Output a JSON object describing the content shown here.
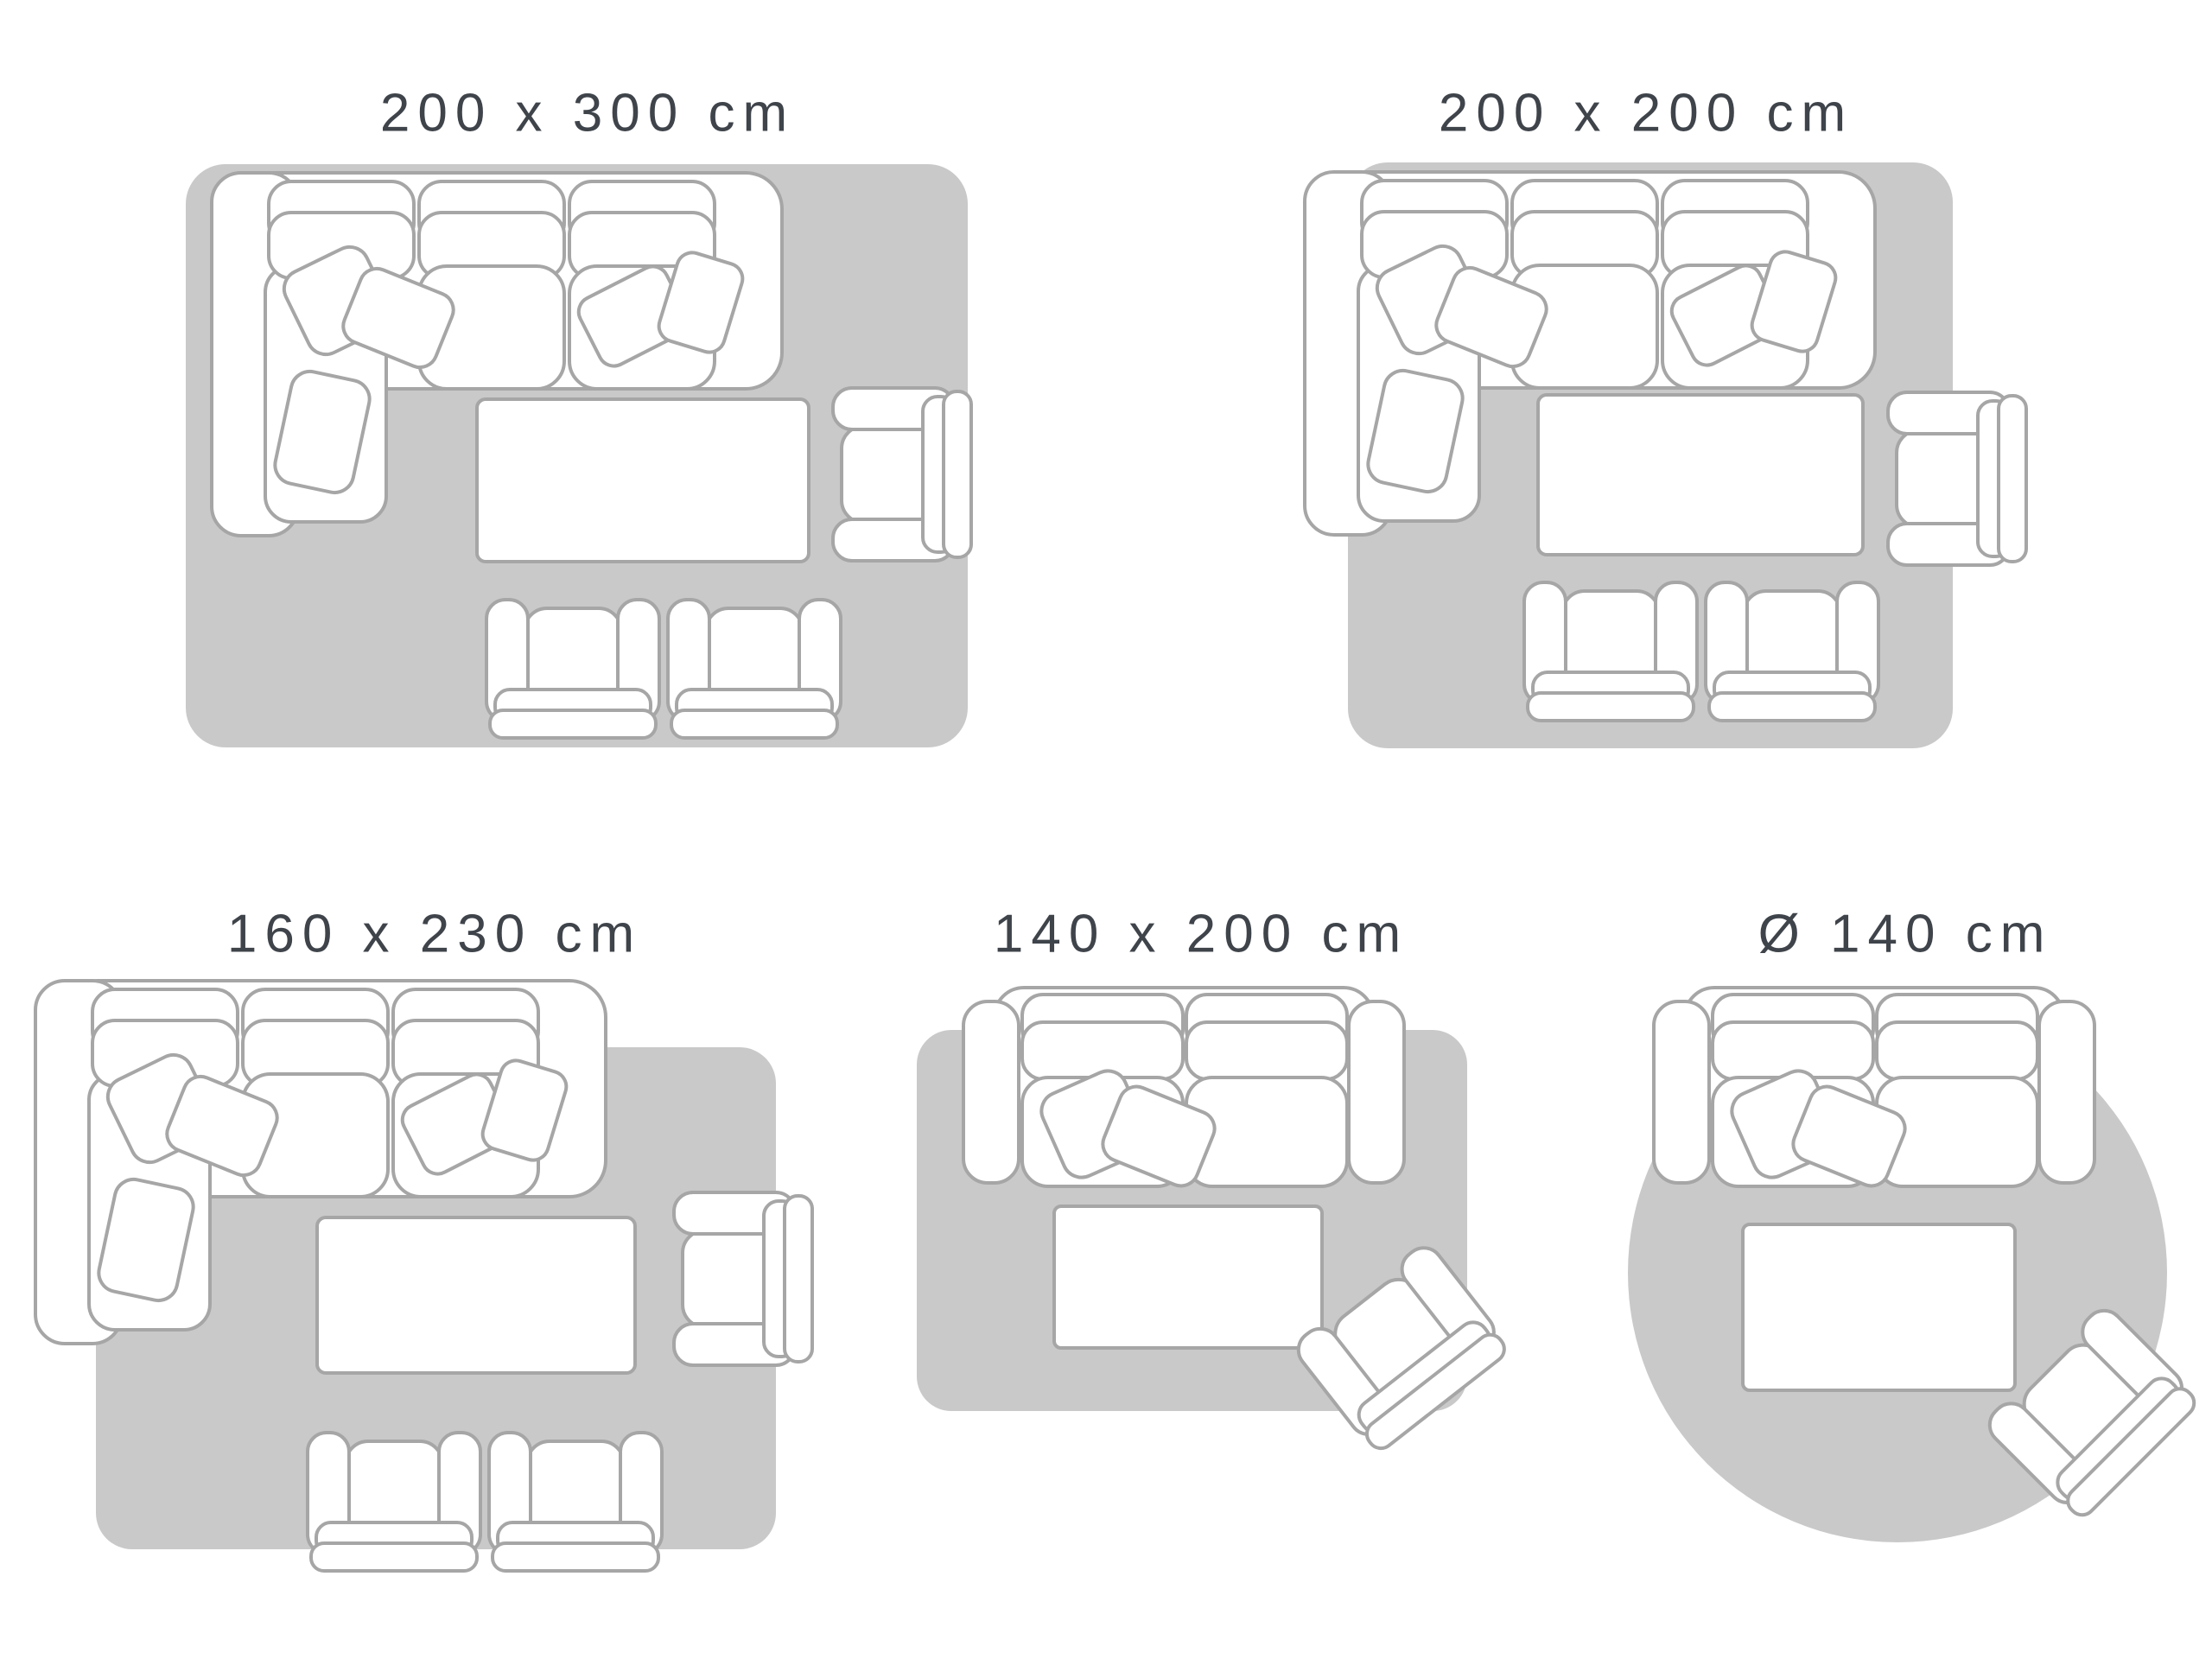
{
  "page": {
    "background": "#ffffff",
    "description": "Rug size guide with five top-down living room layouts"
  },
  "colors": {
    "rug_fill": "#c9c9c9",
    "furniture_fill": "#ffffff",
    "furniture_outline": "#a6a6a6",
    "label_text": "#3f444b"
  },
  "panels": [
    {
      "id": "200x300",
      "label": "200 x 300 cm",
      "rug_shape": "rectangle",
      "furniture": [
        "corner-sofa-with-cushions",
        "coffee-table",
        "side-armchair",
        "armchair",
        "armchair"
      ]
    },
    {
      "id": "200x200",
      "label": "200 x 200 cm",
      "rug_shape": "rectangle",
      "furniture": [
        "corner-sofa-with-cushions",
        "coffee-table",
        "side-armchair",
        "armchair",
        "armchair"
      ]
    },
    {
      "id": "160x230",
      "label": "160 x 230 cm",
      "rug_shape": "rectangle",
      "furniture": [
        "corner-sofa-with-cushions",
        "coffee-table",
        "side-armchair",
        "armchair",
        "armchair"
      ]
    },
    {
      "id": "140x200",
      "label": "140 x 200 cm",
      "rug_shape": "rectangle",
      "furniture": [
        "two-seater-sofa-with-cushions",
        "coffee-table",
        "angled-armchair"
      ]
    },
    {
      "id": "diameter140",
      "label": "Ø 140 cm",
      "rug_shape": "circle",
      "furniture": [
        "two-seater-sofa-with-cushions",
        "coffee-table",
        "angled-armchair"
      ]
    }
  ]
}
